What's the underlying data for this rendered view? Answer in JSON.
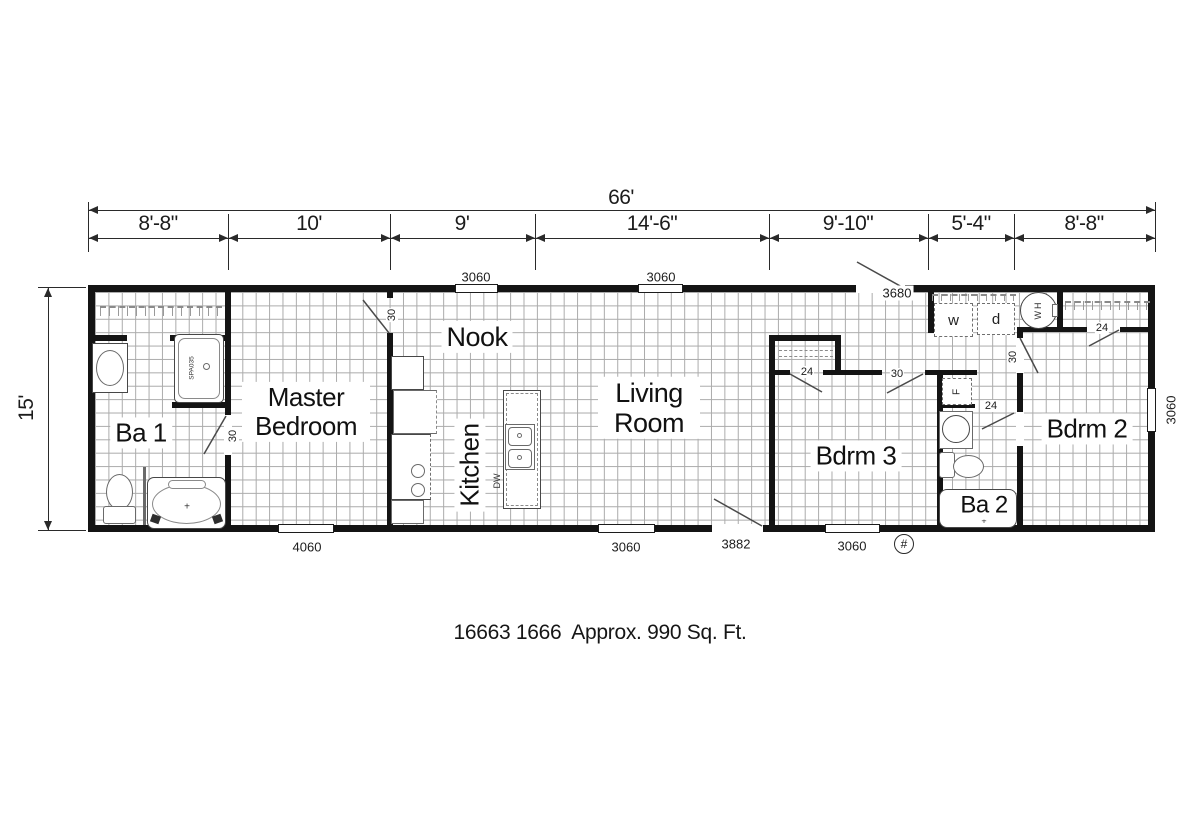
{
  "plan": {
    "caption": "16663 1666  Approx. 990 Sq. Ft.",
    "overall_width_label": "66'",
    "overall_depth_label": "15'",
    "width_segments": [
      "8'-8\"",
      "10'",
      "9'",
      "14'-6\"",
      "9'-10\"",
      "5'-4\"",
      "8'-8\""
    ],
    "rooms": {
      "ba1": "Ba 1",
      "master_bedroom": "Master Bedroom",
      "nook": "Nook",
      "kitchen": "Kitchen",
      "living_room": "Living Room",
      "bdrm3": "Bdrm 3",
      "ba2": "Ba 2",
      "bdrm2": "Bdrm 2"
    },
    "windows": {
      "top_nook": "3060",
      "top_living": "3060",
      "bottom_master": "4060",
      "bottom_living": "3060",
      "bottom_bdrm3": "3060",
      "right_bdrm2": "3060"
    },
    "doors": {
      "rear_entry": "3680",
      "front_entry": "3882",
      "ba1": "30",
      "master_bedroom": "30",
      "bdrm3": "30",
      "bdrm3_closet": "24",
      "bdrm2": "30",
      "bdrm2_closet": "24",
      "ba2": "24"
    },
    "fixtures": {
      "shower_model": "SPA035",
      "washer": "w",
      "dryer": "d",
      "water_heater": "WH",
      "furnace": "F",
      "dishwasher": "DW",
      "utility_marker": "#",
      "tub_marker": "+"
    }
  }
}
